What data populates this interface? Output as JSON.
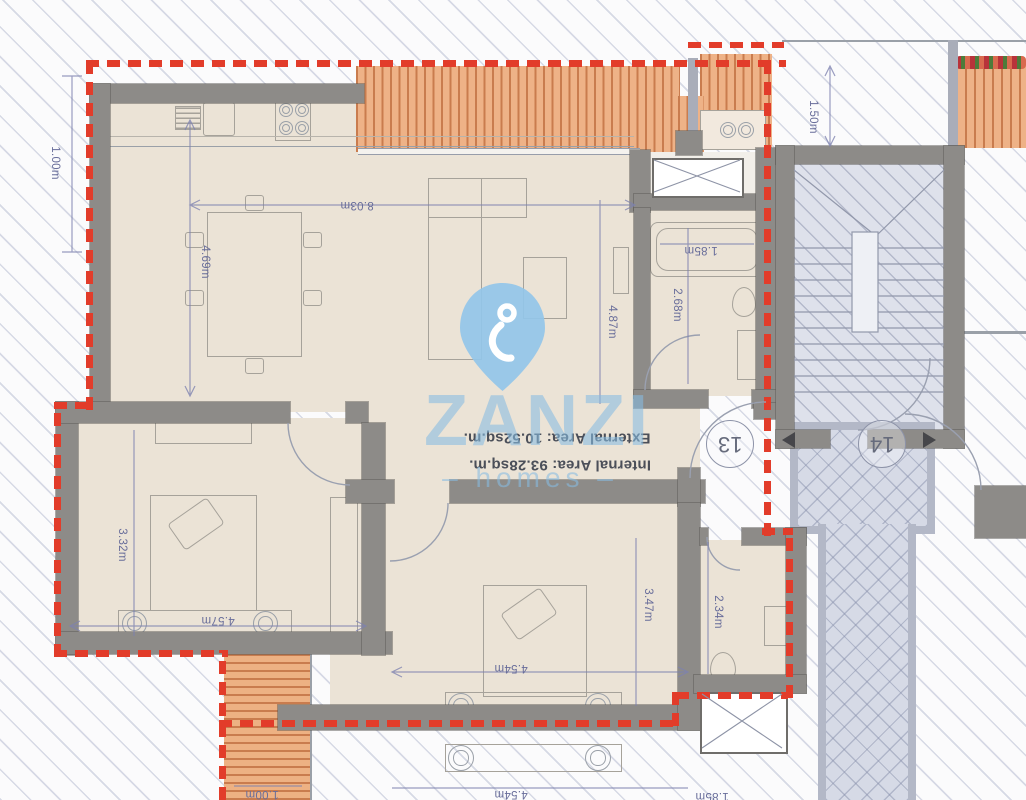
{
  "brand": {
    "name": "ZANZI",
    "tagline": "– homes –"
  },
  "areas": {
    "external": "External Area: 10.52sq.m.",
    "internal": "Internal Area: 93.28sq.m."
  },
  "units": {
    "unit_13": "13",
    "unit_14": "14"
  },
  "dims": {
    "offset_left": "1.00m",
    "living_height": "4.69m",
    "living_width": "8.03m",
    "living_depth": "4.87m",
    "bath_depth": "2.68m",
    "tub_width": "1.85m",
    "terrace_offset": "1.50m",
    "bed1_height": "3.32m",
    "bed1_width": "4.57m",
    "bed2_height": "3.47m",
    "ensuite_depth": "2.34m",
    "bed2_width": "4.54m",
    "lower_bed_width": "4.54m",
    "lower_offset": "1.00m",
    "lower_tub": "1.85m"
  },
  "colors": {
    "boundary_red": "#e23c2a",
    "deck_orange": "#eeb287",
    "wall_gray": "#8d8b88",
    "floor_beige": "#ebe3d6",
    "watermark_blue": "#86bbe2",
    "dimension_blue": "#7d82b0"
  }
}
